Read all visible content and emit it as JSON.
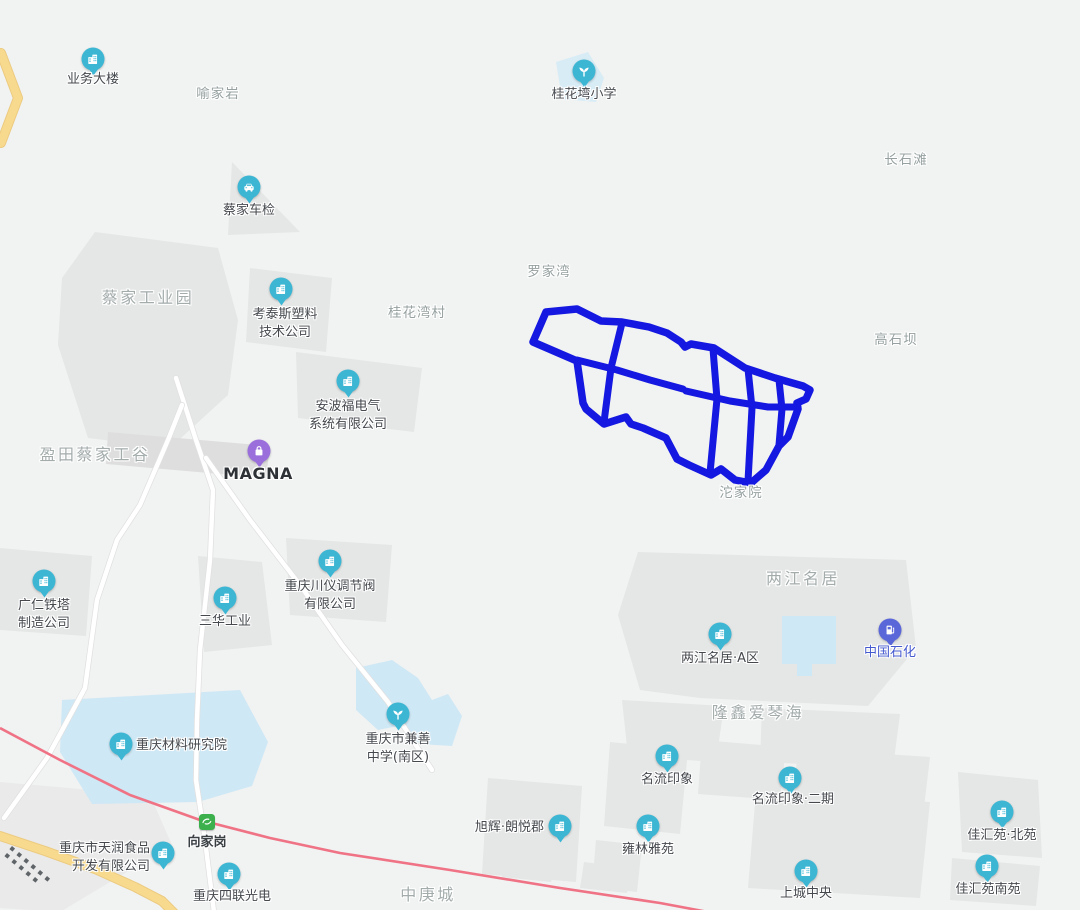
{
  "map": {
    "type": "web-map-viewport",
    "colors": {
      "background": "#f1f2f2",
      "block_gray": "#e5e6e6",
      "block_gray_light": "#eaeaea",
      "water_blue": "#cfe8f5",
      "school_patch_blue": "#d8ecf6",
      "road_white": "#ffffff",
      "road_casing": "#e0e0e0",
      "road_yellow": "#f8da8e",
      "road_yellow_casing": "#eccb80",
      "rail_pink": "#ef7285",
      "selected_region_blue": "#1418e0",
      "pin_teal": "#3cb6d3",
      "pin_purple": "#9a6fdc",
      "pin_indigo": "#5a67d8",
      "station_green": "#3cb04c",
      "poi_text": "#45494e",
      "area_text": "#96a0a0",
      "sinopec_text": "#4559cf"
    },
    "overlay": {
      "name": "highlighted-road-network",
      "description": "thick blue outlined block grid with internal roads",
      "color": "#1418e0"
    },
    "area_labels": [
      {
        "id": "yujiayan",
        "text": "喻家岩",
        "x": 218,
        "y": 94,
        "size": "sm"
      },
      {
        "id": "changshitan",
        "text": "长石滩",
        "x": 906,
        "y": 160,
        "size": "sm"
      },
      {
        "id": "caijia-industrial-park",
        "text": "蔡家工业园",
        "x": 148,
        "y": 298,
        "size": "lg"
      },
      {
        "id": "guihuawan-village",
        "text": "桂花湾村",
        "x": 417,
        "y": 313,
        "size": "sm"
      },
      {
        "id": "luojiawan",
        "text": "罗家湾",
        "x": 549,
        "y": 272,
        "size": "sm"
      },
      {
        "id": "gaoshiba",
        "text": "高石坝",
        "x": 896,
        "y": 340,
        "size": "sm"
      },
      {
        "id": "yingtian-caijia",
        "text": "盈田蔡家工谷",
        "x": 95,
        "y": 455,
        "size": "lg"
      },
      {
        "id": "tuojiayuan",
        "text": "沱家院",
        "x": 741,
        "y": 493,
        "size": "sm"
      },
      {
        "id": "liangjiang-mingju",
        "text": "两江名居",
        "x": 803,
        "y": 579,
        "size": "lg"
      },
      {
        "id": "longxin-aiqinhai",
        "text": "隆鑫爱琴海",
        "x": 758,
        "y": 713,
        "size": "lg"
      },
      {
        "id": "zhonggengcheng",
        "text": "中庚城",
        "x": 428,
        "y": 895,
        "size": "lg"
      }
    ],
    "pois": [
      {
        "id": "yewu-dalou",
        "icon": "building-icon",
        "pin": "pin_teal",
        "x": 93,
        "y": 59,
        "lines": [
          "业务大楼"
        ],
        "lx": 93,
        "ly": 80,
        "align": "center"
      },
      {
        "id": "guihuawan-school",
        "icon": "school-icon",
        "pin": "pin_teal",
        "x": 584,
        "y": 71,
        "lines": [
          "桂花塆小学"
        ],
        "lx": 584,
        "ly": 95,
        "align": "center"
      },
      {
        "id": "caijia-vehicle-inspection",
        "icon": "car-icon",
        "pin": "pin_teal",
        "x": 249,
        "y": 187,
        "lines": [
          "蔡家车检"
        ],
        "lx": 249,
        "ly": 211,
        "align": "center"
      },
      {
        "id": "kaotaisi",
        "icon": "building-icon",
        "pin": "pin_teal",
        "x": 281,
        "y": 289,
        "lines": [
          "考泰斯塑料",
          "技术公司"
        ],
        "lx": 285,
        "ly": 324,
        "align": "center"
      },
      {
        "id": "anbofu",
        "icon": "building-icon",
        "pin": "pin_teal",
        "x": 348,
        "y": 381,
        "lines": [
          "安波福电气",
          "系统有限公司"
        ],
        "lx": 348,
        "ly": 416,
        "align": "center"
      },
      {
        "id": "magna",
        "icon": "bag-icon",
        "pin": "pin_purple",
        "x": 259,
        "y": 451,
        "lines": [
          "MAGNA"
        ],
        "lx": 258,
        "ly": 474,
        "align": "center",
        "style": "magna"
      },
      {
        "id": "guangren-tieta",
        "icon": "building-icon",
        "pin": "pin_teal",
        "x": 44,
        "y": 581,
        "lines": [
          "广仁铁塔",
          "制造公司"
        ],
        "lx": 44,
        "ly": 615,
        "align": "center"
      },
      {
        "id": "sanhua",
        "icon": "building-icon",
        "pin": "pin_teal",
        "x": 225,
        "y": 598,
        "lines": [
          "三华工业"
        ],
        "lx": 225,
        "ly": 622,
        "align": "center"
      },
      {
        "id": "chuanyi-valve",
        "icon": "building-icon",
        "pin": "pin_teal",
        "x": 330,
        "y": 561,
        "lines": [
          "重庆川仪调节阀",
          "有限公司"
        ],
        "lx": 330,
        "ly": 596,
        "align": "center"
      },
      {
        "id": "liangjiang-a",
        "icon": "building-icon",
        "pin": "pin_teal",
        "x": 720,
        "y": 634,
        "lines": [
          "两江名居·A区"
        ],
        "lx": 720,
        "ly": 659,
        "align": "center"
      },
      {
        "id": "sinopec",
        "icon": "gas-icon",
        "pin": "pin_indigo",
        "x": 890,
        "y": 630,
        "lines": [
          "中国石化"
        ],
        "lx": 890,
        "ly": 653,
        "align": "center",
        "style": "blue"
      },
      {
        "id": "cailiao-institute",
        "icon": "building-icon",
        "pin": "pin_teal",
        "x": 121,
        "y": 744,
        "lines": [
          "重庆材料研究院"
        ],
        "lx": 136,
        "ly": 746,
        "align": "left"
      },
      {
        "id": "jianshan-school",
        "icon": "school-icon",
        "pin": "pin_teal",
        "x": 398,
        "y": 714,
        "lines": [
          "重庆市兼善",
          "中学(南区)"
        ],
        "lx": 398,
        "ly": 749,
        "align": "center"
      },
      {
        "id": "mingliu",
        "icon": "building-icon",
        "pin": "pin_teal",
        "x": 667,
        "y": 756,
        "lines": [
          "名流印象"
        ],
        "lx": 667,
        "ly": 780,
        "align": "center"
      },
      {
        "id": "mingliu-phase2",
        "icon": "building-icon",
        "pin": "pin_teal",
        "x": 790,
        "y": 778,
        "lines": [
          "名流印象·二期"
        ],
        "lx": 793,
        "ly": 800,
        "align": "center"
      },
      {
        "id": "xuhui",
        "icon": "building-icon",
        "pin": "pin_teal",
        "x": 560,
        "y": 826,
        "lines": [
          "旭辉·朗悦郡"
        ],
        "lx": 544,
        "ly": 828,
        "align": "right"
      },
      {
        "id": "yonglin",
        "icon": "building-icon",
        "pin": "pin_teal",
        "x": 648,
        "y": 826,
        "lines": [
          "雍林雅苑"
        ],
        "lx": 648,
        "ly": 850,
        "align": "center"
      },
      {
        "id": "shangcheng-central",
        "icon": "building-icon",
        "pin": "pin_teal",
        "x": 806,
        "y": 871,
        "lines": [
          "上城中央"
        ],
        "lx": 806,
        "ly": 894,
        "align": "center"
      },
      {
        "id": "jiahui-north",
        "icon": "building-icon",
        "pin": "pin_teal",
        "x": 1002,
        "y": 812,
        "lines": [
          "佳汇苑·北苑"
        ],
        "lx": 1002,
        "ly": 836,
        "align": "center"
      },
      {
        "id": "jiahui-south",
        "icon": "building-icon",
        "pin": "pin_teal",
        "x": 987,
        "y": 866,
        "lines": [
          "佳汇苑南苑"
        ],
        "lx": 988,
        "ly": 890,
        "align": "center"
      },
      {
        "id": "tianrun-food",
        "icon": "building-icon",
        "pin": "pin_teal",
        "x": 163,
        "y": 853,
        "lines": [
          "重庆市天润食品",
          "开发有限公司"
        ],
        "lx": 150,
        "ly": 858,
        "align": "right"
      },
      {
        "id": "silian-optoelectronics",
        "icon": "building-icon",
        "pin": "pin_teal",
        "x": 229,
        "y": 874,
        "lines": [
          "重庆四联光电"
        ],
        "lx": 232,
        "ly": 897,
        "align": "center"
      },
      {
        "id": "xiangjiagang-station",
        "icon": "train-icon",
        "pin": "station_green",
        "x": 207,
        "y": 822,
        "lines": [
          "向家岗"
        ],
        "lx": 207,
        "ly": 843,
        "align": "center",
        "style": "station",
        "shape": "square"
      }
    ]
  }
}
